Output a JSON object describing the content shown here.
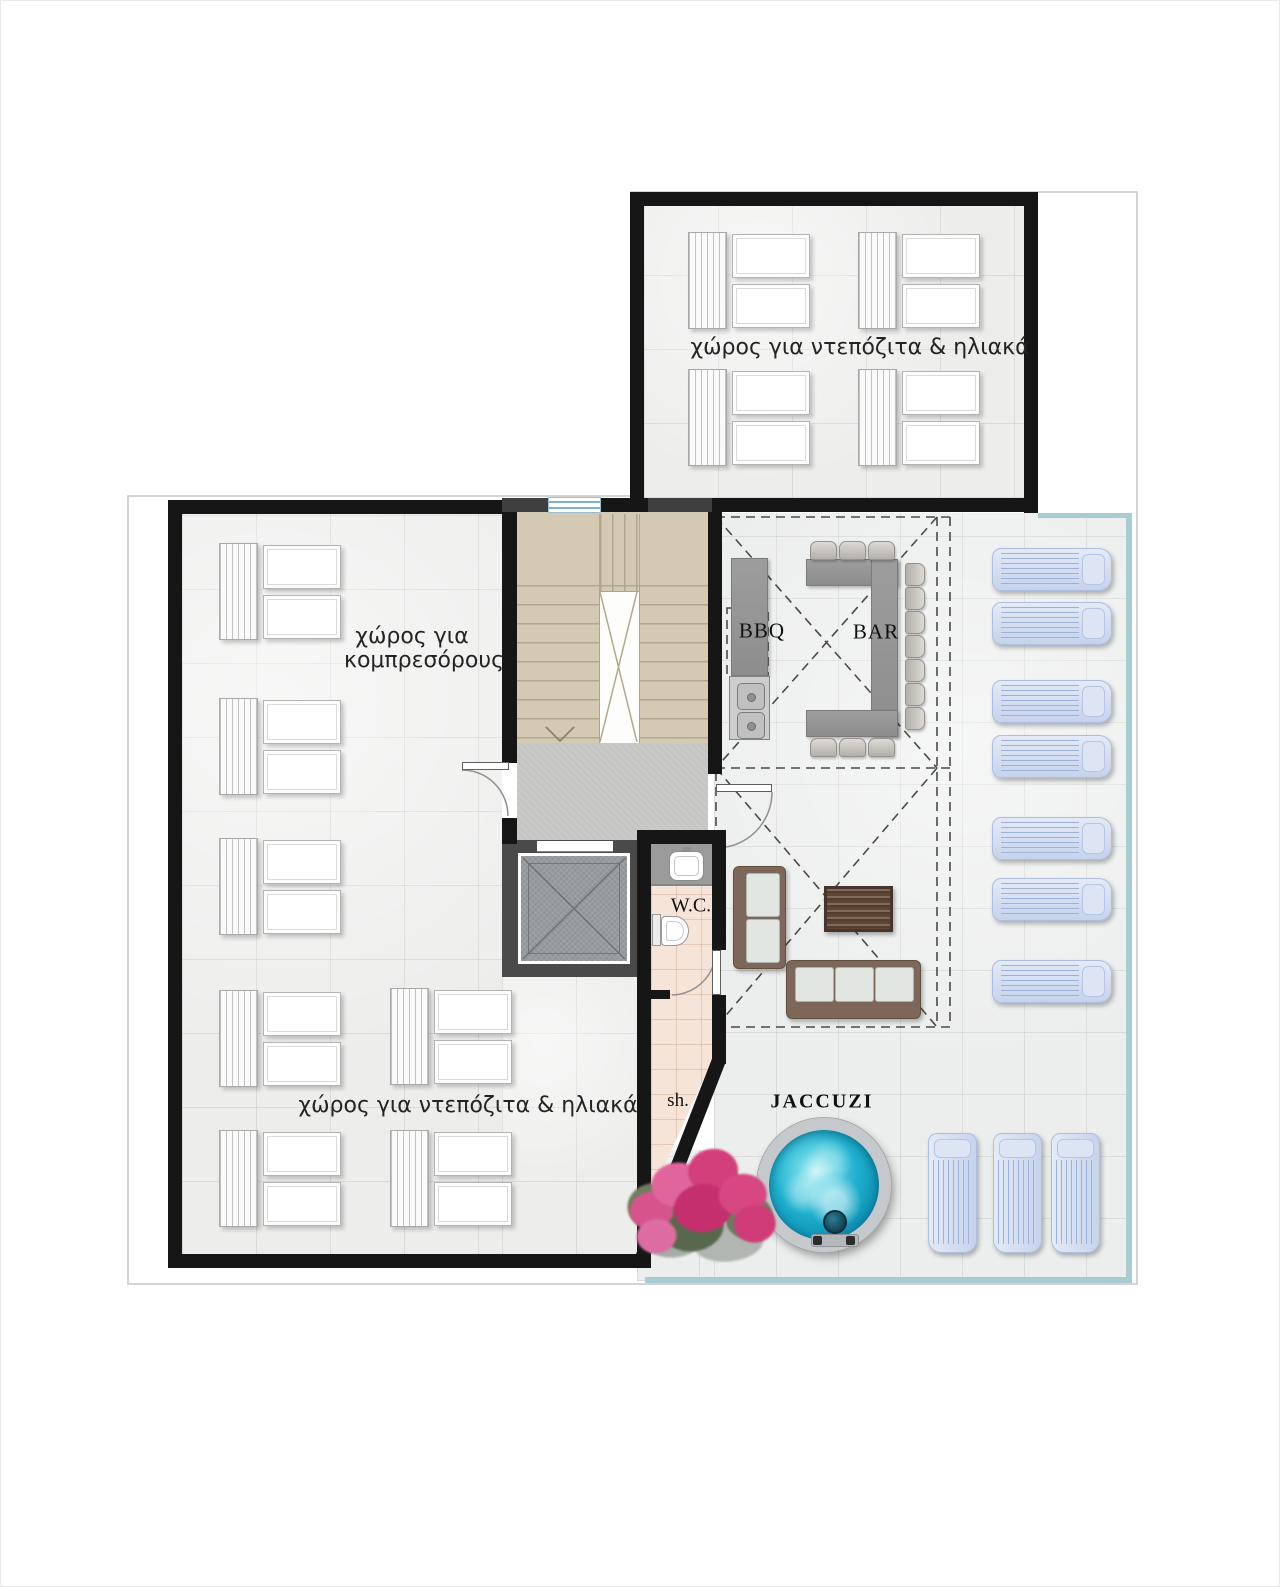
{
  "labels": {
    "roof_room": "χώρος για ντεπόζιτα & ηλιακά",
    "compressors_line1": "χώρος για",
    "compressors_line2": "κομπρεσόρους",
    "storage_room": "χώρος για ντεπόζιτα & ηλιακά",
    "bbq": "BBQ",
    "bar": "BAR",
    "wc": "W.C.",
    "shower": "sh.",
    "jacuzzi": "JACCUZI"
  },
  "furniture": {
    "solar_panel_groups_roof_room": 4,
    "solar_panel_groups_main_room": 7,
    "tanks_per_group": 2,
    "sun_loungers_right": 7,
    "sun_loungers_bottom": 3,
    "bar_stools": 13,
    "sofas": 2,
    "coffee_tables": 1,
    "jacuzzis": 1,
    "bbq_sinks": 1
  },
  "colors": {
    "wall": "#161616",
    "inner_wall_dark": "#4a4a4a",
    "tile_floor": "#edeeec",
    "stair_floor": "#d4c9b3",
    "bathroom_floor": "#f6e4d8",
    "terrace_trim": "#a9ccd3",
    "jacuzzi_water": "#1fb0cf",
    "lounger": "#d3dff0",
    "bougainvillea": "#d84b85",
    "counter_gray": "#979797"
  }
}
